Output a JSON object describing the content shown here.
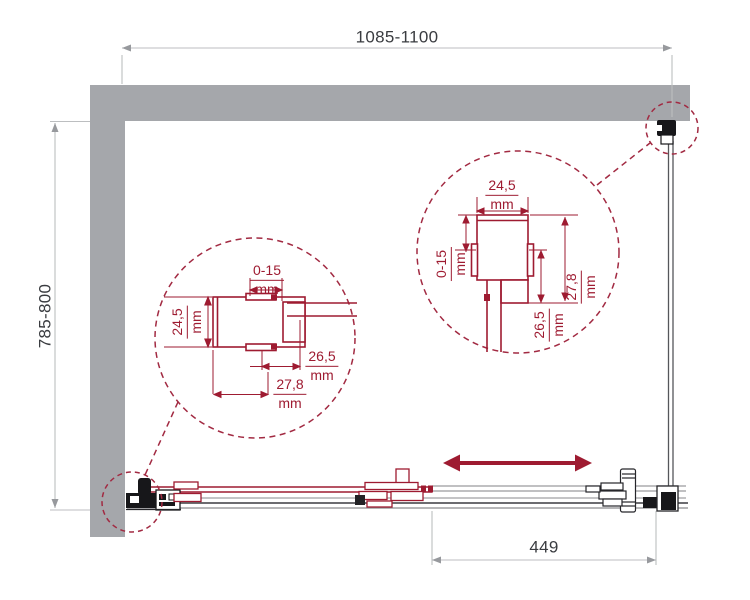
{
  "drawing": {
    "overall_width_label": "1085-1100",
    "overall_depth_label": "785-800",
    "door_opening_label": "449"
  },
  "detail_left": {
    "adjustment": {
      "value": "0-15",
      "unit": "mm"
    },
    "profile_depth": {
      "value": "24,5",
      "unit": "mm"
    },
    "dim_26_5": {
      "value": "26,5",
      "unit": "mm"
    },
    "dim_27_8": {
      "value": "27,8",
      "unit": "mm"
    }
  },
  "detail_right": {
    "profile_depth": {
      "value": "24,5",
      "unit": "mm"
    },
    "adjustment": {
      "value": "0-15",
      "unit": "mm"
    },
    "dim_26_5": {
      "value": "26,5",
      "unit": "mm"
    },
    "dim_27_8": {
      "value": "27,8",
      "unit": "mm"
    }
  },
  "colors": {
    "accent_red": "#9e1b31",
    "dashed_red": "#a22a42",
    "wall_gray": "#a5a7ab",
    "dim_text": "#3a3c40",
    "dim_line": "#bcbec0"
  }
}
